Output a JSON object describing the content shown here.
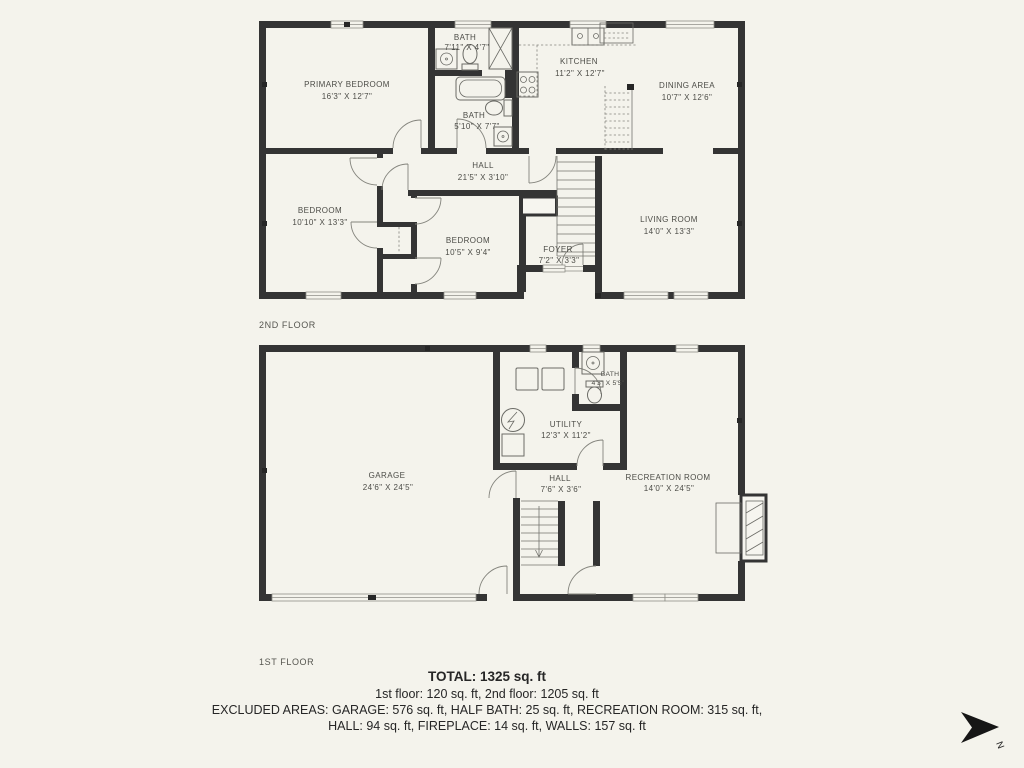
{
  "floors": [
    {
      "label": "2ND FLOOR",
      "rooms": [
        {
          "name": "PRIMARY BEDROOM",
          "dims": "16'3\" X 12'7\""
        },
        {
          "name": "BATH",
          "dims": "7'11\" X 4'7\""
        },
        {
          "name": "KITCHEN",
          "dims": "11'2\" X 12'7\""
        },
        {
          "name": "DINING AREA",
          "dims": "10'7\" X 12'6\""
        },
        {
          "name": "BATH",
          "dims": "5'10\" X 7'7\""
        },
        {
          "name": "HALL",
          "dims": "21'5\" X 3'10\""
        },
        {
          "name": "BEDROOM",
          "dims": "10'10\" X 13'3\""
        },
        {
          "name": "BEDROOM",
          "dims": "10'5\" X 9'4\""
        },
        {
          "name": "FOYER",
          "dims": "7'2\" X 3'3\""
        },
        {
          "name": "LIVING ROOM",
          "dims": "14'0\" X 13'3\""
        }
      ]
    },
    {
      "label": "1ST FLOOR",
      "rooms": [
        {
          "name": "GARAGE",
          "dims": "24'6\" X 24'5\""
        },
        {
          "name": "UTILITY",
          "dims": "12'3\" X 11'2\""
        },
        {
          "name": "BATH",
          "dims": "4'3\" X 5'5\""
        },
        {
          "name": "HALL",
          "dims": "7'6\" X 3'6\""
        },
        {
          "name": "RECREATION ROOM",
          "dims": "14'0\" X 24'5\""
        }
      ]
    }
  ],
  "summary": {
    "total": "TOTAL: 1325 sq. ft",
    "floors_line": "1st floor: 120 sq. ft, 2nd floor: 1205 sq. ft",
    "excluded_line1": "EXCLUDED AREAS: GARAGE: 576 sq. ft, HALF BATH: 25 sq. ft, RECREATION ROOM: 315 sq. ft,",
    "excluded_line2": "HALL: 94 sq. ft, FIREPLACE: 14 sq. ft, WALLS: 157 sq. ft"
  },
  "compass": {
    "north_label": "N"
  },
  "colors": {
    "wall": "#343434",
    "background": "#f4f3ec",
    "line": "#6b6b66",
    "text": "#4c4c47",
    "summary_text": "#262626"
  }
}
